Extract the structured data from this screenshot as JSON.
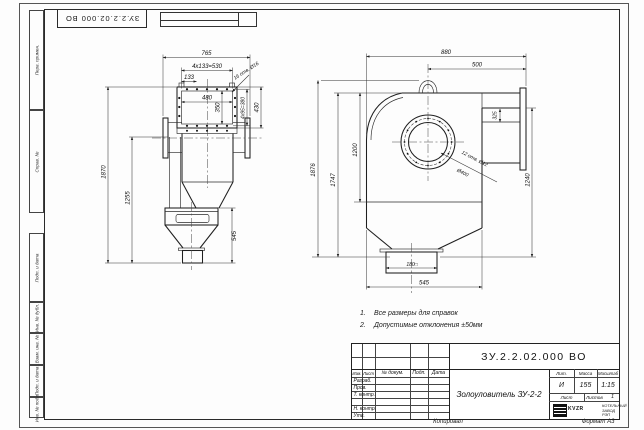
{
  "corner_stamp": {
    "doc_number": "ЗУ.2.2.02.000 ВО"
  },
  "margin_labels": {
    "perv": "Перв. примен.",
    "sprav": "Справ. №",
    "podp1": "Подп. и дата",
    "inv_dubl": "Инв. № дубл.",
    "vzam": "Взам. инв. №",
    "podp2": "Подп. и дата",
    "inv_podl": "Инв. № подл."
  },
  "front_view": {
    "total_width": "765",
    "bolt_span": "4x133=530",
    "first_bolt": "133",
    "inner_width": "480",
    "inner_height": "350",
    "side_bolt_span": "4x95=380",
    "flange_height": "430",
    "holes_note": "16 отв. Ø16",
    "total_height": "1870",
    "body_height": "1255",
    "hopper_height": "545"
  },
  "side_view": {
    "total_width": "880",
    "outlet_offset": "500",
    "holes_note": "12 отв. Ø12",
    "flange_dia": "Ø400",
    "duct_dim": "325",
    "outlet_height": "1240",
    "total_height": "1876",
    "casing_height": "1747",
    "center_height": "1200",
    "outlet_size": "180□",
    "base_width": "545"
  },
  "notes": {
    "n1_num": "1.",
    "n1_text": "Все размеры для справок",
    "n2_num": "2.",
    "n2_text": "Допустимые отклонения ±50мм"
  },
  "title_block": {
    "doc_number": "ЗУ.2.2.02.000 ВО",
    "product_name": "Золоуловитель ЗУ-2-2",
    "col_izm": "Изм.",
    "col_list": "Лист",
    "col_doc": "№ докум.",
    "col_podp": "Подп.",
    "col_data": "Дата",
    "row_razrab": "Разраб.",
    "row_prov": "Пров.",
    "row_tkontr": "Т. контр.",
    "row_nkontr": "Н. контр.",
    "row_utv": "Утв.",
    "lit_label": "Лит.",
    "mass_label": "Масса",
    "scale_label": "Масштаб",
    "lit_value": "И",
    "mass_value": "155",
    "scale_value": "1:15",
    "sheet_label": "Лист",
    "sheets_label": "Листов",
    "sheets_value": "1",
    "logo_text": "KVZR",
    "logo_line1": "КОТЕЛЬНЫЙ",
    "logo_line2": "ЗАВОД РЭП"
  },
  "footer": {
    "copied": "Копировал",
    "format": "Формат А3"
  }
}
